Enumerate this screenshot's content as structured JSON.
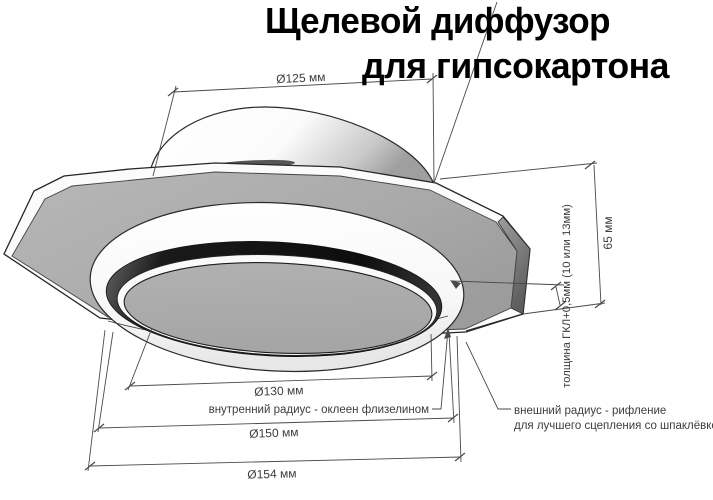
{
  "title": {
    "line1": "Щелевой диффузор",
    "line2": "для гипсокартона"
  },
  "dimensions": {
    "duct_diameter": "Ø125 мм",
    "height": "65 мм",
    "board_thickness": "толщина ГКЛ+0,5мм (10 или 13мм)",
    "inner_diameter": "Ø130 мм",
    "middle_diameter": "Ø150 мм",
    "outer_diameter": "Ø154 мм"
  },
  "notes": {
    "inner_radius": "внутренний радиус - оклеен флизелином",
    "outer_radius_line1": "внешний радиус - рифление",
    "outer_radius_line2": "для лучшего сцепления со шпаклёвкой"
  },
  "colors": {
    "background": "#ffffff",
    "plate_gray": "#a9a9a9",
    "slot_dark": "#161616",
    "outline": "#262626",
    "dimension": "#4a4a4a",
    "text": "#3d3d3d",
    "title": "#000000"
  }
}
